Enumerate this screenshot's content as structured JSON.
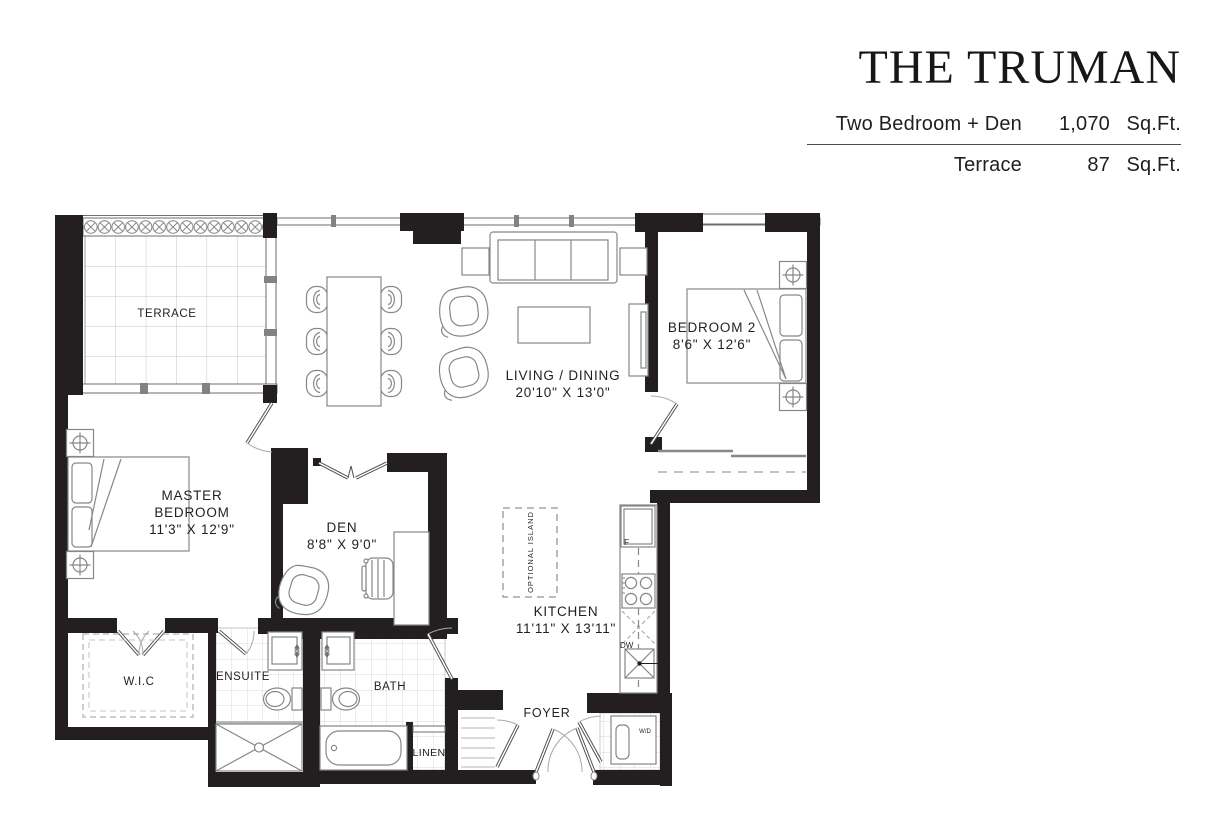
{
  "header": {
    "title": "THE TRUMAN",
    "rows": [
      {
        "label": "Two Bedroom + Den",
        "value": "1,070",
        "unit": "Sq.Ft."
      },
      {
        "label": "Terrace",
        "value": "87",
        "unit": "Sq.Ft."
      }
    ]
  },
  "rooms": {
    "terrace": {
      "label": "TERRACE"
    },
    "living_dining": {
      "label": "LIVING / DINING",
      "dims": "20'10\" X 13'0\""
    },
    "bedroom2": {
      "label": "BEDROOM 2",
      "dims": "8'6\" X 12'6\""
    },
    "master_bedroom": {
      "label_line1": "MASTER",
      "label_line2": "BEDROOM",
      "dims": "11'3\" X 12'9\""
    },
    "den": {
      "label": "DEN",
      "dims": "8'8\" X 9'0\""
    },
    "kitchen": {
      "label": "KITCHEN",
      "dims": "11'11\" X 13'11\""
    },
    "wic": {
      "label": "W.I.C"
    },
    "ensuite": {
      "label": "ENSUITE"
    },
    "bath": {
      "label": "BATH"
    },
    "linen": {
      "label": "LINEN"
    },
    "foyer": {
      "label": "FOYER"
    }
  },
  "annotations": {
    "optional_island": "OPTIONAL ISLAND",
    "fridge": "F",
    "dishwasher": "DW",
    "washer_dryer": "W/D"
  },
  "colors": {
    "wall": "#231f20",
    "furniture_line": "#85878a",
    "tile_line": "#d7d8d9",
    "text": "#231f20"
  }
}
